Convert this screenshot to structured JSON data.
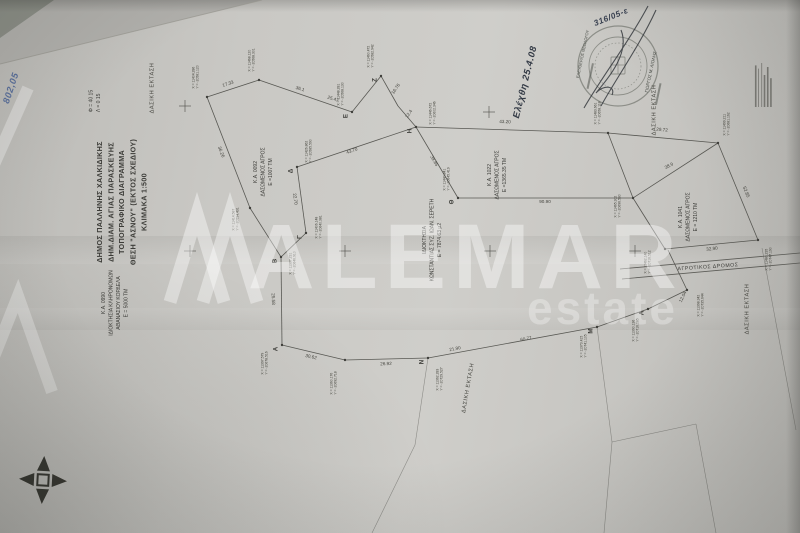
{
  "title_block": {
    "lines": [
      "ΔΗΜΟΣ ΠΑΛΛΗΝΗΣ ΧΑΛΚΙΔΙΚΗΣ",
      "ΔΗΜ.ΔΙΑΜ. ΑΓΙΑΣ ΠΑΡΑΣΚΕΥΗΣ",
      "ΤΟΠΟΓΡΑΦΙΚΟ ΔΙΑΓΡΑΜΜΑ",
      "ΘΕΣΗ \"ΑΣΝΟΥ\" (ΕΚΤΟΣ ΣΧΕΔΙΟΥ)",
      "ΚΛΙΜΑΚΑ 1:500"
    ]
  },
  "geo_reference": {
    "lines": [
      "Φ = 40  15",
      "Λ = 0  15"
    ]
  },
  "watermark": {
    "brand": "ALEMAR",
    "sub": "estate"
  },
  "road": {
    "label": "ΑΓΡΟΤΙΚΟΣ ΔΡΟΜΟΣ"
  },
  "stamp": {
    "left_name": "ΕΛΕΥΘΕΡΙΟΣ ΘΕΟΛΟΓΟΥ",
    "right_name": "ΓΙΩΡΓΟΣ Μ. ΛΙΟΛΗΣ"
  },
  "handwriting": [
    {
      "text": "Ελέχθη  25.4.08",
      "x": 525,
      "y": 82,
      "rot": -76,
      "scale": 0.62,
      "size": 15,
      "color": "#333a45"
    },
    {
      "text": "316/05-ε",
      "x": 611,
      "y": 17,
      "rot": -22,
      "scale": 0.55,
      "size": 15,
      "color": "#3a4252"
    },
    {
      "text": "802,05",
      "x": 11,
      "y": 88,
      "rot": -72,
      "scale": 0.62,
      "size": 15,
      "color": "#5a6f9a"
    }
  ],
  "forest_labels": [
    {
      "text": "ΔΑΣΙΚΗ ΕΚΤΑΣΗ",
      "x": 152,
      "y": 88,
      "rot": -90
    },
    {
      "text": "ΔΑΣΙΚΗ ΕΚΤΑΣΗ",
      "x": 654,
      "y": 110,
      "rot": -90
    },
    {
      "text": "ΔΑΣΙΚΗ ΕΚΤΑΣΗ",
      "x": 468,
      "y": 388,
      "rot": -80
    },
    {
      "text": "ΔΑΣΙΚΗ ΕΚΤΑΣΗ",
      "x": 747,
      "y": 309,
      "rot": -90
    }
  ],
  "parcels": [
    {
      "x": 263,
      "y": 172,
      "lines": [
        "Κ.Α. 0092",
        "ΔΑΣΩΜΕΝΟΣ ΑΓΡΟΣ",
        "Ε =1007 ΤΜ"
      ]
    },
    {
      "x": 497,
      "y": 175,
      "lines": [
        "Κ.Α. 1022",
        "ΔΑΣΩΜΕΝΟΣ ΑΓΡΟΣ",
        "Ε =1365.35 ΤΜ"
      ]
    },
    {
      "x": 688,
      "y": 217,
      "lines": [
        "Κ.Α. 1041",
        "ΔΑΣΩΜΕΝΟΣ ΑΓΡΟΣ",
        "Ε = 1210 ΤΜ"
      ]
    },
    {
      "x": 115,
      "y": 303,
      "lines": [
        "Κ.Α. 0990",
        "ΙΔΙΟΚΤΗΣΙΑ ΚΛΗΡΟΝΟΜΩΝ",
        "ΑΘΑΝΑΣΙΟΥ ΚΟΡΔΕΛΑ",
        "Ε = 5000 ΤΜ"
      ]
    },
    {
      "x": 432,
      "y": 240,
      "lines": [
        "ΙΔΙΟΚΤΗΣΙΑ",
        "ΚΩΝΣΤΑΝΤΙΑΣ ΣΥΖ. ΙΩΑΝ. ΣΕΡΕΤΗ",
        "Ε = 7874.63 μ2"
      ]
    }
  ],
  "survey": {
    "segments": [
      [
        207,
        97,
        259,
        80
      ],
      [
        259,
        80,
        352,
        112
      ],
      [
        352,
        112,
        381,
        76
      ],
      [
        381,
        76,
        398,
        106
      ],
      [
        398,
        106,
        416,
        127
      ],
      [
        416,
        127,
        608,
        133
      ],
      [
        608,
        133,
        718,
        143
      ],
      [
        718,
        143,
        758,
        240
      ],
      [
        758,
        240,
        665,
        249
      ],
      [
        665,
        249,
        633,
        198
      ],
      [
        633,
        198,
        718,
        143
      ],
      [
        416,
        127,
        297,
        167
      ],
      [
        297,
        167,
        306,
        233
      ],
      [
        306,
        233,
        281,
        257
      ],
      [
        281,
        257,
        282,
        345
      ],
      [
        207,
        97,
        250,
        208
      ],
      [
        250,
        208,
        281,
        257
      ],
      [
        416,
        127,
        458,
        198
      ],
      [
        458,
        198,
        633,
        198
      ],
      [
        608,
        133,
        633,
        198
      ],
      [
        282,
        345,
        345,
        360
      ],
      [
        345,
        360,
        428,
        358
      ],
      [
        428,
        358,
        597,
        327
      ],
      [
        597,
        327,
        648,
        309
      ],
      [
        648,
        309,
        687,
        290
      ],
      [
        687,
        290,
        668,
        250
      ]
    ],
    "faint_segments": [
      [
        428,
        358,
        415,
        445
      ],
      [
        415,
        445,
        372,
        533
      ],
      [
        597,
        327,
        612,
        442
      ],
      [
        612,
        442,
        604,
        533
      ],
      [
        612,
        442,
        696,
        424
      ],
      [
        696,
        424,
        716,
        533
      ],
      [
        762,
        248,
        796,
        430
      ]
    ],
    "road_lines": [
      [
        620,
        269,
        800,
        253
      ],
      [
        622,
        279,
        800,
        263
      ]
    ],
    "crosses": [
      [
        185,
        106
      ],
      [
        489,
        112
      ],
      [
        190,
        251
      ],
      [
        345,
        251
      ],
      [
        490,
        251
      ],
      [
        635,
        251
      ]
    ],
    "vertices": [
      {
        "letter": "",
        "x": 207,
        "y": 97,
        "lx": 196,
        "ly": 77,
        "coords": [
          "Χ = 11404.286",
          "Υ = -20581.120"
        ]
      },
      {
        "letter": "",
        "x": 259,
        "y": 80,
        "lx": 252,
        "ly": 60,
        "coords": [
          "Χ = 11468.120",
          "Υ = -20568.301"
        ]
      },
      {
        "letter": "Ε",
        "x": 352,
        "y": 112,
        "lx": 341,
        "ly": 94,
        "coords": [
          "Χ = 11448.281",
          "Υ = -20568.130"
        ]
      },
      {
        "letter": "Ζ",
        "x": 381,
        "y": 76,
        "lx": 371,
        "ly": 56,
        "coords": [
          "Χ = 11460.472",
          "Υ = -20582.942"
        ]
      },
      {
        "letter": "Η",
        "x": 416,
        "y": 127,
        "lx": 433,
        "ly": 113,
        "coords": [
          "Χ = 11446.672",
          "Υ = -20602.346"
        ]
      },
      {
        "letter": "Θ",
        "x": 458,
        "y": 198,
        "lx": 447,
        "ly": 179,
        "coords": [
          "Χ = 11440.841",
          "Υ = -20645.419"
        ]
      },
      {
        "letter": "Δ",
        "x": 297,
        "y": 167,
        "lx": 309,
        "ly": 151,
        "coords": [
          "Χ = 11426.862",
          "Υ = -20585.590"
        ]
      },
      {
        "letter": "Γ",
        "x": 306,
        "y": 233,
        "lx": 319,
        "ly": 227,
        "coords": [
          "Χ = 11406.148",
          "Υ = -20640.381"
        ]
      },
      {
        "letter": "Β",
        "x": 281,
        "y": 257,
        "lx": 293,
        "ly": 263,
        "coords": [
          "Χ = 11397.231",
          "Υ = -20646.910"
        ]
      },
      {
        "letter": "Α",
        "x": 282,
        "y": 345,
        "lx": 265,
        "ly": 363,
        "coords": [
          "Χ = 11397.579",
          "Υ = -20678.516"
        ]
      },
      {
        "letter": "",
        "x": 345,
        "y": 360,
        "lx": 334,
        "ly": 383,
        "coords": [
          "Χ = 11360.176",
          "Υ = -20692.718"
        ]
      },
      {
        "letter": "Ν",
        "x": 428,
        "y": 358,
        "lx": 440,
        "ly": 379,
        "coords": [
          "Χ = 11362.283",
          "Υ = -20729.527"
        ]
      },
      {
        "letter": "Μ",
        "x": 597,
        "y": 327,
        "lx": 584,
        "ly": 346,
        "coords": [
          "Χ = 11373.415",
          "Υ = -20741.105"
        ]
      },
      {
        "letter": "Λ",
        "x": 648,
        "y": 309,
        "lx": 636,
        "ly": 330,
        "coords": [
          "Χ = 11390.136",
          "Υ = -20716.285"
        ]
      },
      {
        "letter": "",
        "x": 687,
        "y": 290,
        "lx": 701,
        "ly": 305,
        "coords": [
          "Χ = 11398.342",
          "Υ = -20735.644"
        ]
      },
      {
        "letter": "",
        "x": 608,
        "y": 133,
        "lx": 598,
        "ly": 113,
        "coords": [
          "Χ = 11483.661",
          "Υ = -20658.118"
        ]
      },
      {
        "letter": "",
        "x": 718,
        "y": 143,
        "lx": 727,
        "ly": 124,
        "coords": [
          "Χ = 11499.211",
          "Υ = -20681.162"
        ]
      },
      {
        "letter": "",
        "x": 758,
        "y": 240,
        "lx": 769,
        "ly": 259,
        "coords": [
          "Χ = 11480.235",
          "Υ = -20747.190"
        ]
      },
      {
        "letter": "",
        "x": 665,
        "y": 249,
        "lx": 648,
        "ly": 262,
        "coords": [
          "Χ = 11462.140",
          "Υ = -20716.512"
        ]
      },
      {
        "letter": "",
        "x": 633,
        "y": 198,
        "lx": 618,
        "ly": 206,
        "coords": [
          "Χ = 11465.302",
          "Υ = -20696.580"
        ]
      },
      {
        "letter": "",
        "x": 250,
        "y": 208,
        "lx": 236,
        "ly": 219,
        "coords": [
          "Χ = 11414.587",
          "Υ = -20594.431"
        ]
      }
    ],
    "distances": [
      {
        "v": "17.33",
        "x": 228,
        "y": 84,
        "r": -18
      },
      {
        "v": "36.1",
        "x": 300,
        "y": 89,
        "r": 18
      },
      {
        "v": "25.47",
        "x": 333,
        "y": 99,
        "r": 18
      },
      {
        "v": "16.76",
        "x": 396,
        "y": 89,
        "r": -55
      },
      {
        "v": "12.4",
        "x": 409,
        "y": 114,
        "r": -55
      },
      {
        "v": "43.20",
        "x": 505,
        "y": 122,
        "r": 2
      },
      {
        "v": "29.72",
        "x": 662,
        "y": 130,
        "r": 5
      },
      {
        "v": "43.70",
        "x": 352,
        "y": 151,
        "r": -19
      },
      {
        "v": "22.70",
        "x": 295,
        "y": 199,
        "r": 82
      },
      {
        "v": "25.58",
        "x": 273,
        "y": 299,
        "r": 88
      },
      {
        "v": "36.26",
        "x": 221,
        "y": 152,
        "r": 69
      },
      {
        "v": "30.62",
        "x": 311,
        "y": 357,
        "r": 13
      },
      {
        "v": "26.92",
        "x": 386,
        "y": 364,
        "r": -2
      },
      {
        "v": "21.90",
        "x": 455,
        "y": 349,
        "r": -11
      },
      {
        "v": "60.77",
        "x": 526,
        "y": 339,
        "r": -11
      },
      {
        "v": "12.04",
        "x": 683,
        "y": 297,
        "r": -64
      },
      {
        "v": "38.9",
        "x": 669,
        "y": 166,
        "r": -28
      },
      {
        "v": "52.85",
        "x": 746,
        "y": 192,
        "r": 68
      },
      {
        "v": "32.90",
        "x": 712,
        "y": 249,
        "r": -6
      },
      {
        "v": "90.90",
        "x": 545,
        "y": 202,
        "r": 0
      },
      {
        "v": "39.85",
        "x": 434,
        "y": 161,
        "r": 60
      }
    ]
  },
  "fine_print": {
    "bar_widths": [
      52,
      48,
      55,
      40,
      50,
      36
    ]
  },
  "colors": {
    "paper": "#c9c8c4",
    "ink": "#4c4c47",
    "watermark": "rgba(255,255,255,0.40)",
    "handwriting_blue": "#5a6f9a"
  }
}
